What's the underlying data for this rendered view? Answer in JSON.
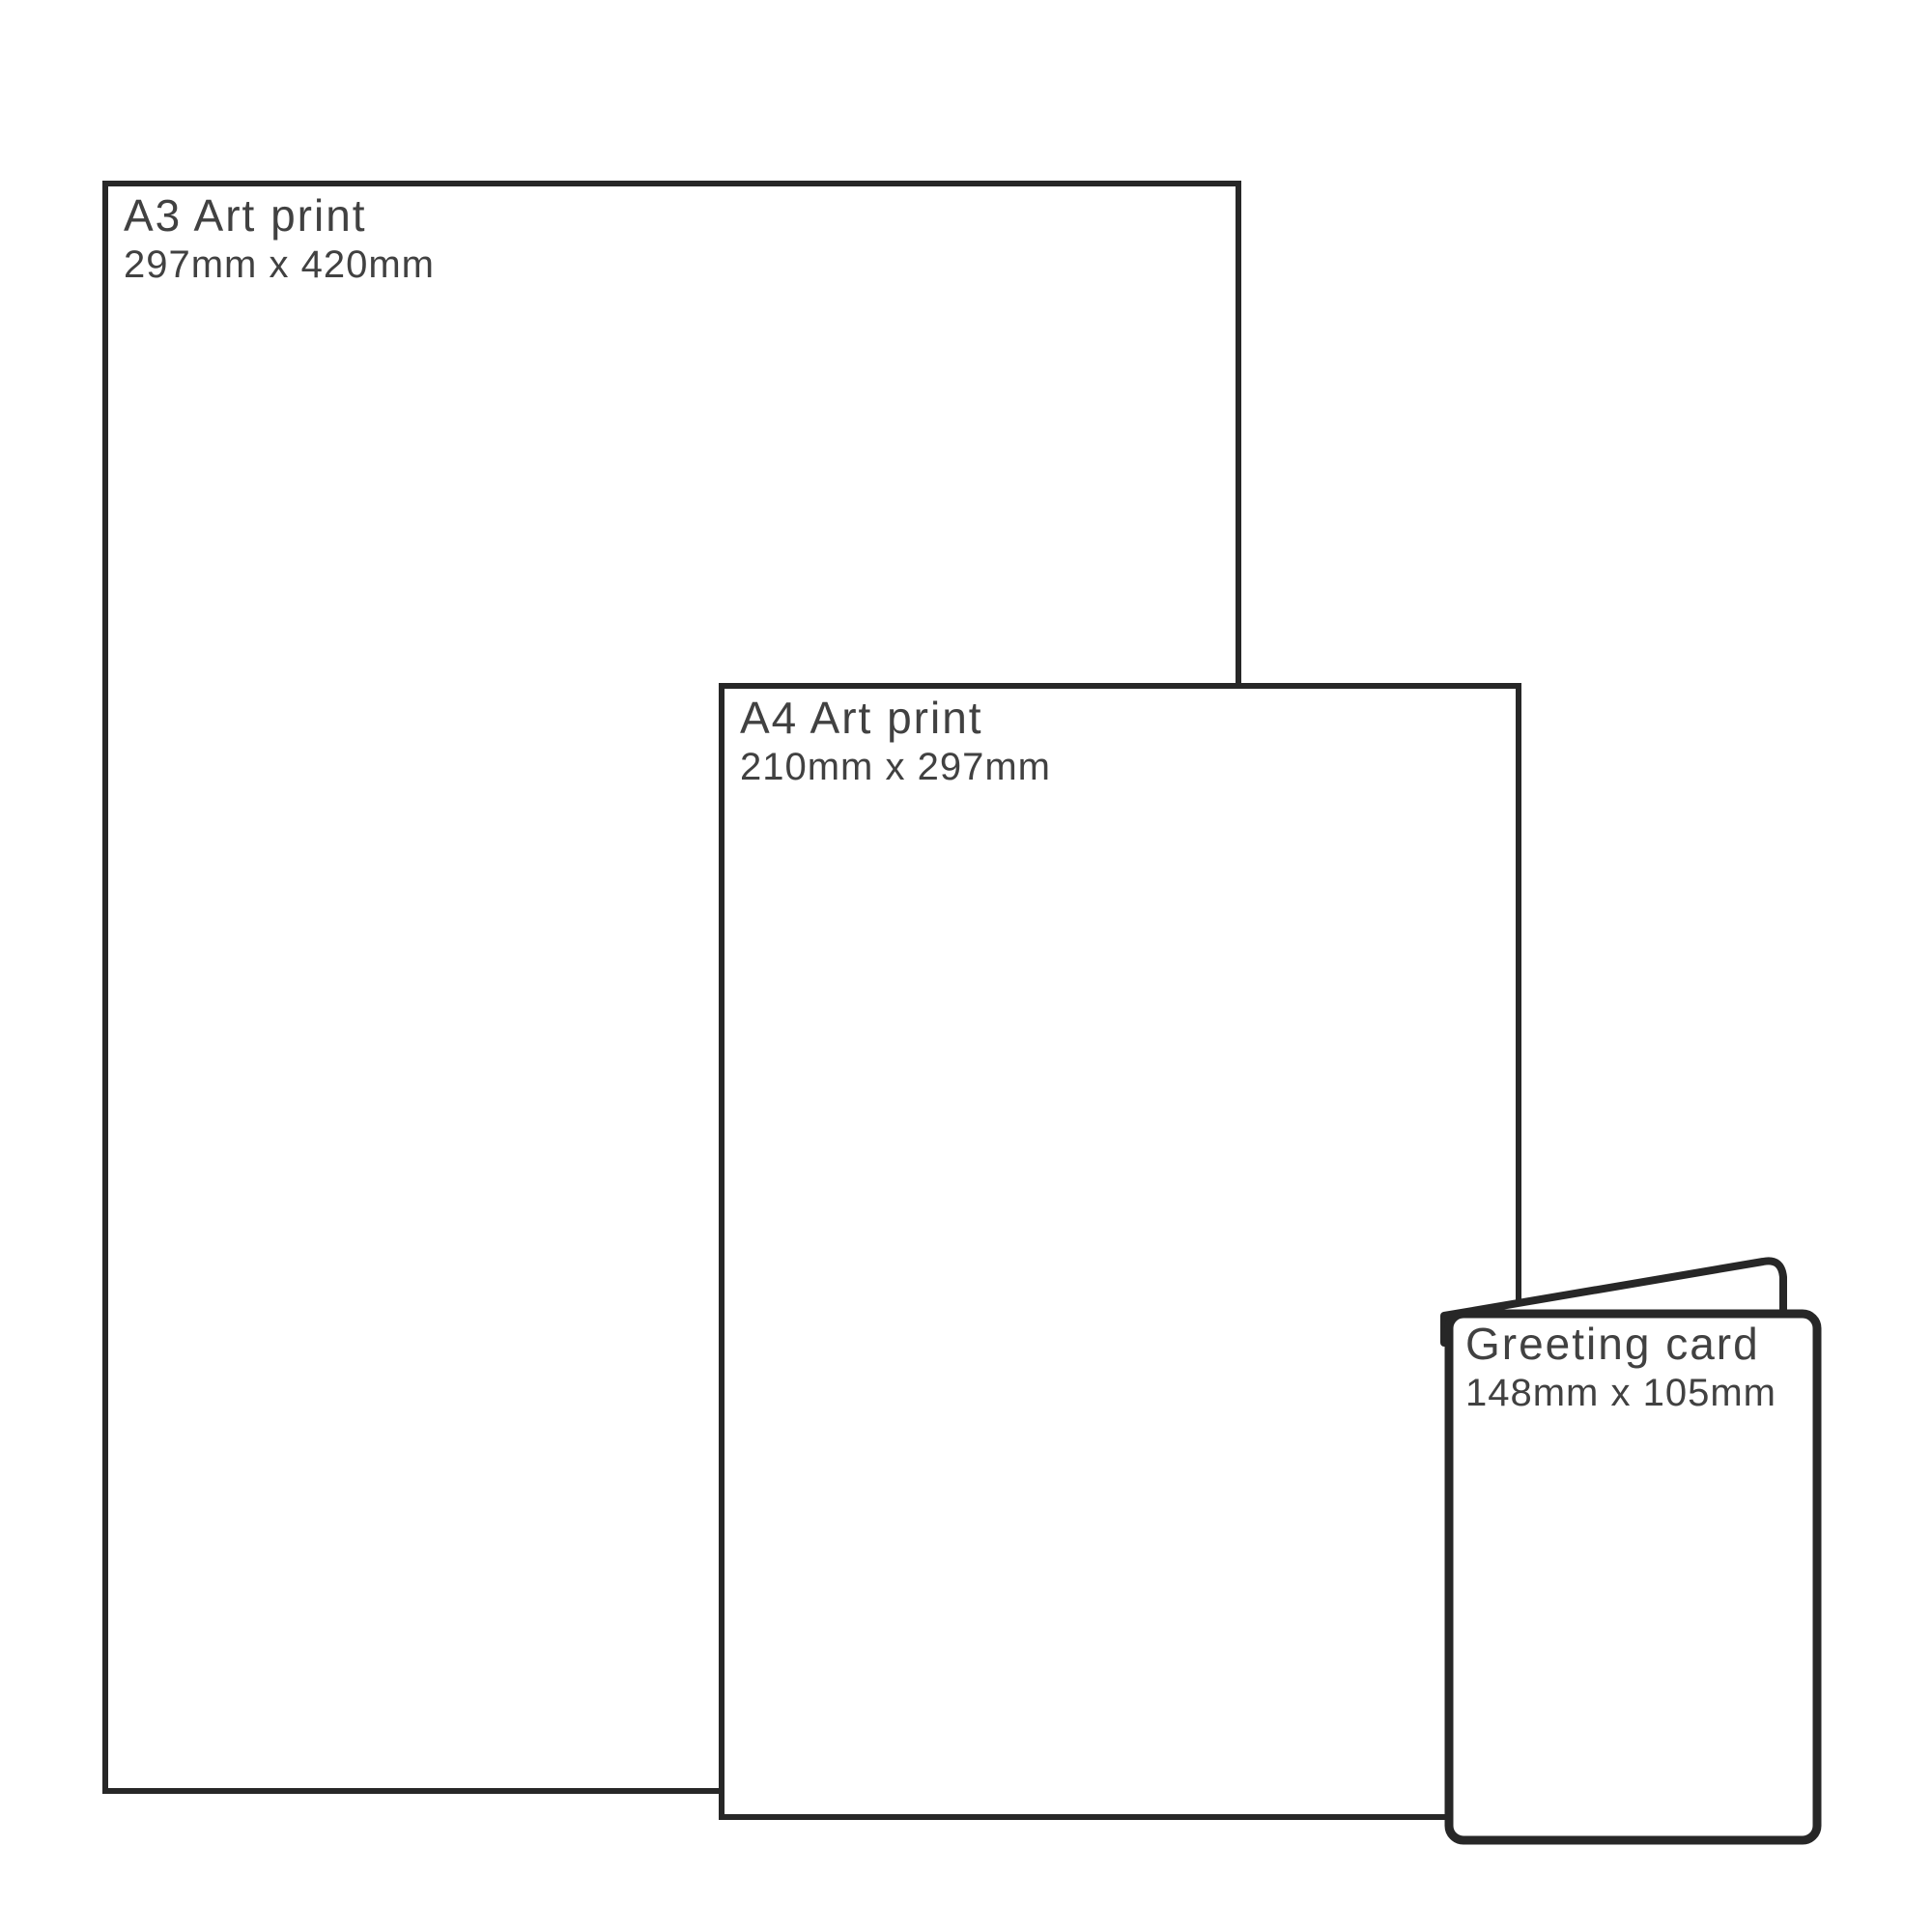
{
  "diagram": {
    "items": [
      {
        "id": "a3-print",
        "title": "A3 Art print",
        "dimensions": "297mm x 420mm"
      },
      {
        "id": "a4-print",
        "title": "A4 Art print",
        "dimensions": "210mm x 297mm"
      },
      {
        "id": "greeting-card",
        "title": "Greeting card",
        "dimensions": "148mm x 105mm"
      }
    ],
    "colors": {
      "outline": "#272727",
      "text": "#414141",
      "background": "#ffffff"
    }
  }
}
